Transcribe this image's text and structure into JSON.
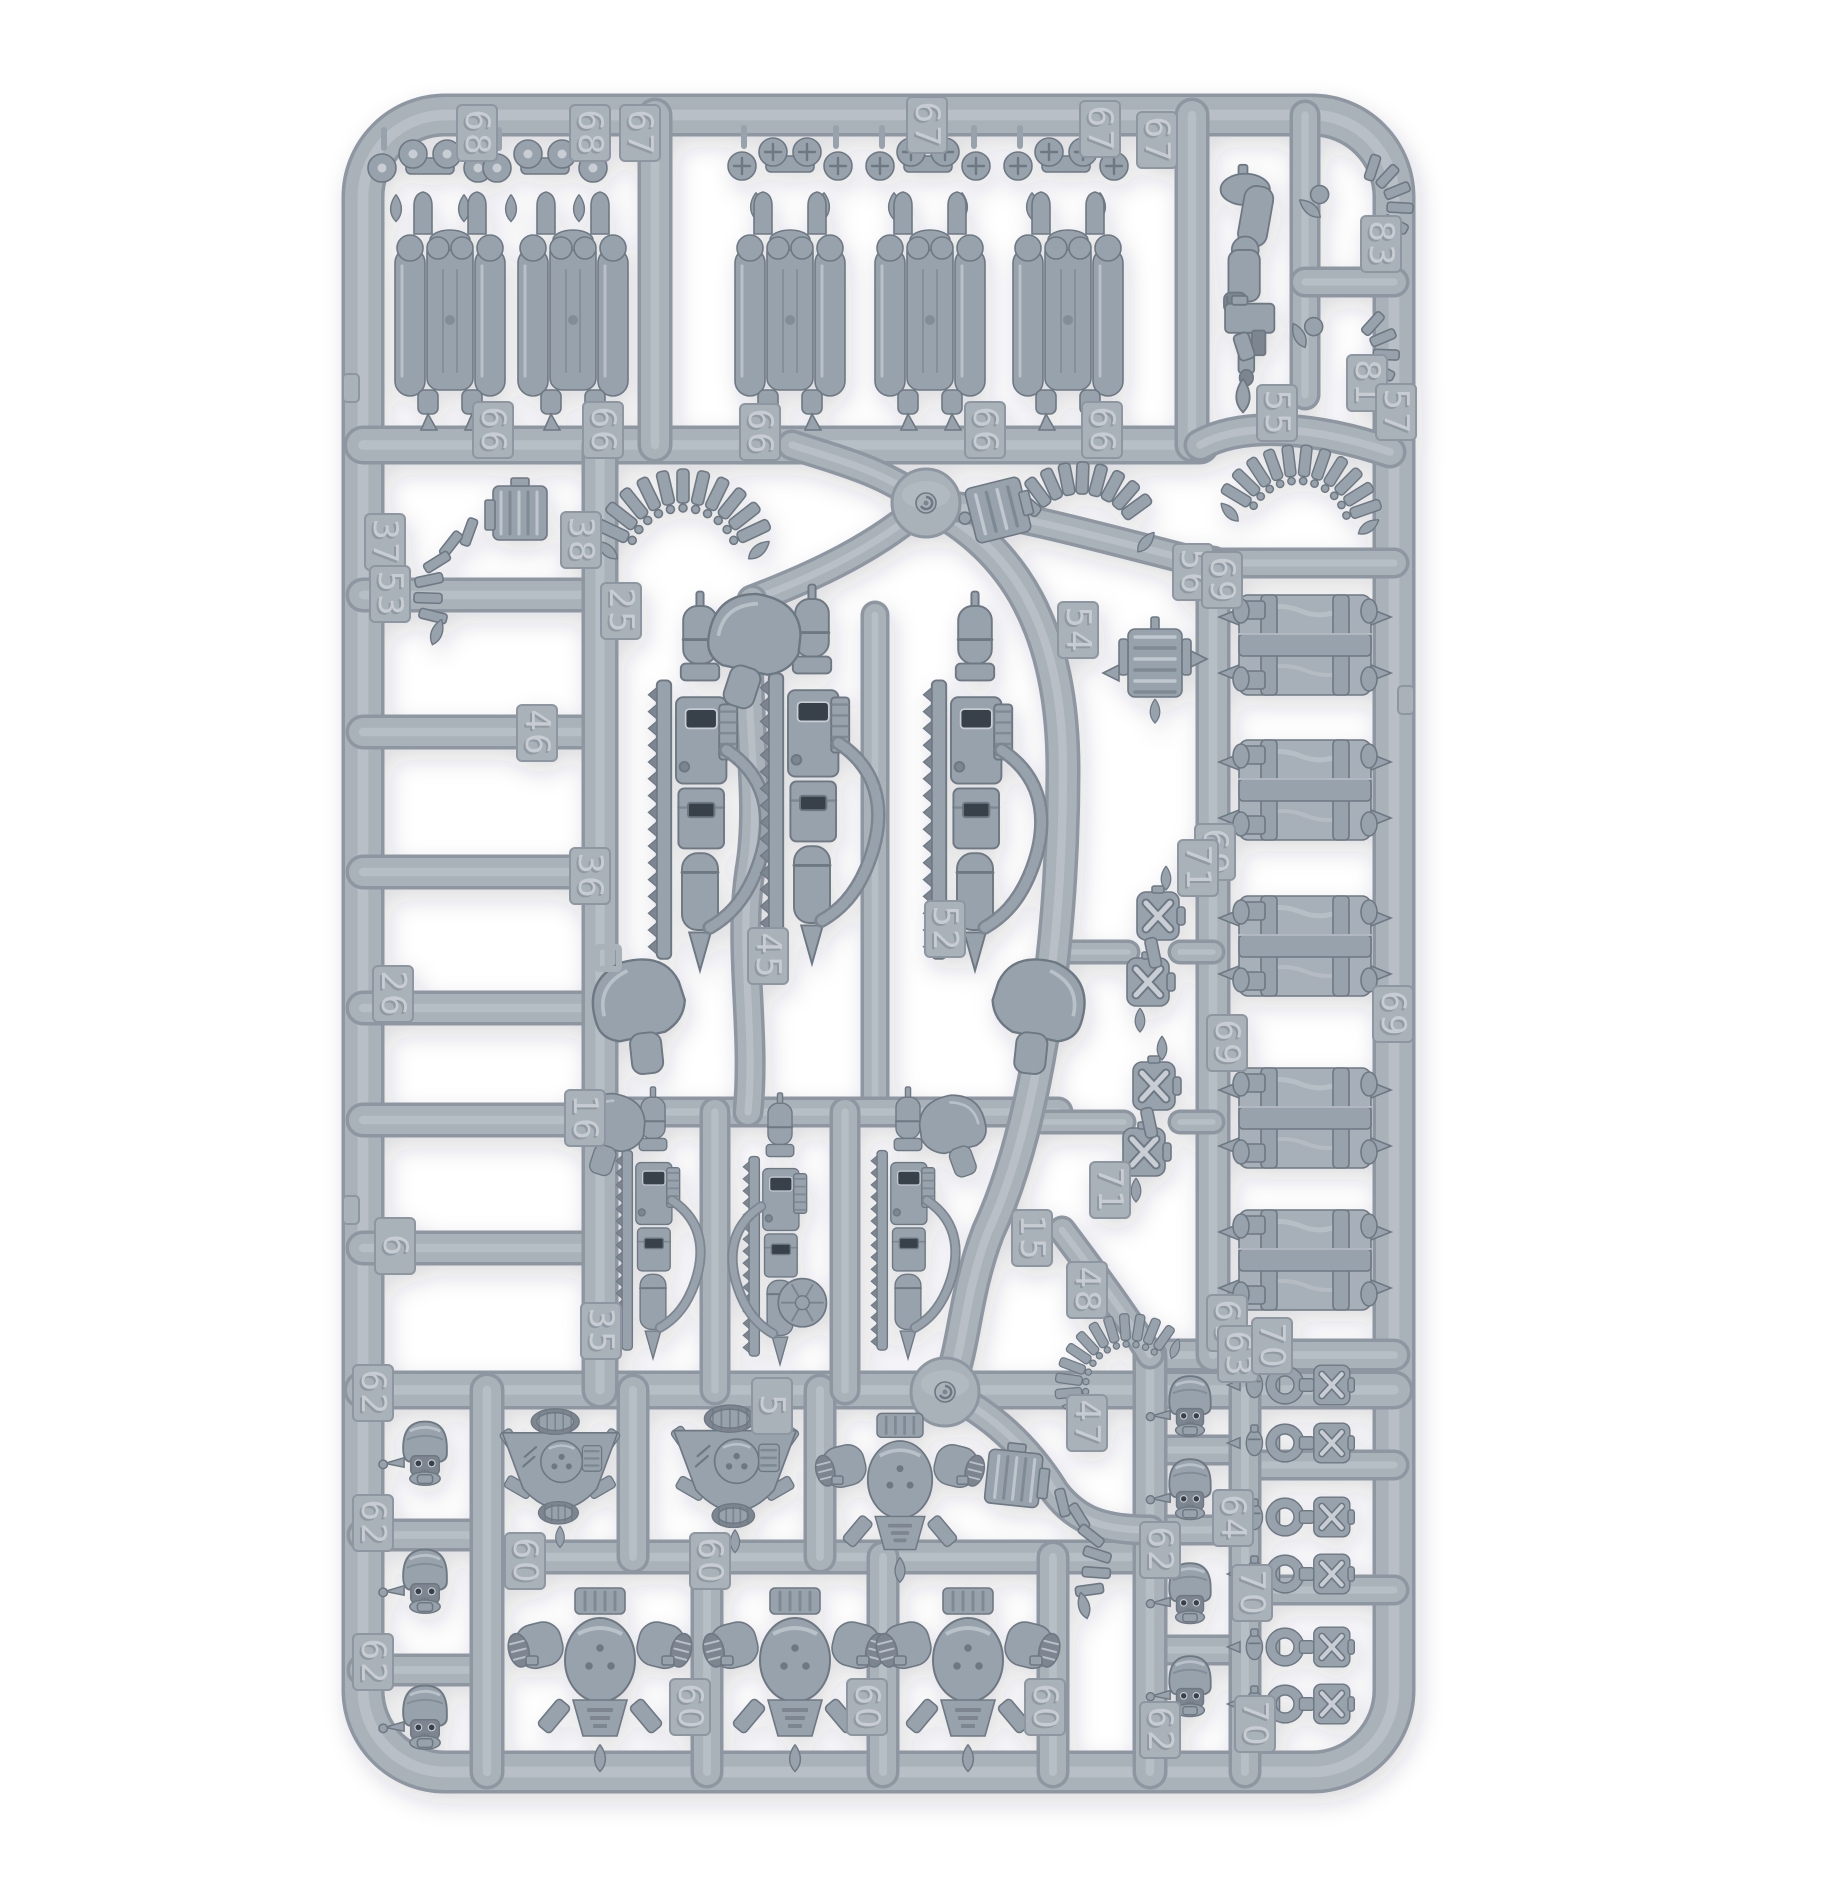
{
  "image": {
    "kind": "product-photo",
    "subject": "plastic-model-sprue",
    "background": "#ffffff",
    "palette": {
      "edge": "#8e97a1",
      "body": "#a9b1b9",
      "hi": "#c4cbd1",
      "pbase": "#98a2ac",
      "pdark": "#7b8590",
      "plight": "#c8ced4",
      "pline": "#6e7883",
      "win": "#384049",
      "crate": "#a7b0b8",
      "numfill": "#c9cfd5",
      "numshadow": "#7e8892"
    },
    "frame": {
      "x": 363,
      "y": 115,
      "w": 1031,
      "h": 1657,
      "rx": 82,
      "bar": 36
    },
    "hubs": [
      [
        926,
        503,
        34
      ],
      [
        945,
        1392,
        34
      ]
    ],
    "rails": [
      [
        363,
        445,
        1200,
        445,
        32
      ],
      [
        363,
        595,
        600,
        595,
        28
      ],
      [
        363,
        732,
        600,
        732,
        28
      ],
      [
        363,
        872,
        600,
        872,
        28
      ],
      [
        363,
        1008,
        600,
        1008,
        28
      ],
      [
        363,
        1120,
        600,
        1120,
        28
      ],
      [
        363,
        1248,
        600,
        1248,
        28
      ],
      [
        363,
        1390,
        1394,
        1390,
        32
      ],
      [
        363,
        1535,
        487,
        1535,
        26
      ],
      [
        363,
        1670,
        487,
        1670,
        26
      ],
      [
        487,
        1557,
        1150,
        1557,
        28
      ],
      [
        1150,
        1355,
        1394,
        1355,
        26
      ],
      [
        1150,
        1450,
        1245,
        1450,
        24
      ],
      [
        1150,
        1530,
        1245,
        1530,
        24
      ],
      [
        1150,
        1650,
        1245,
        1650,
        24
      ],
      [
        1245,
        1465,
        1394,
        1465,
        24
      ],
      [
        1245,
        1590,
        1394,
        1590,
        24
      ],
      [
        600,
        445,
        600,
        1390,
        30
      ],
      [
        487,
        1390,
        487,
        1772,
        28
      ],
      [
        633,
        1390,
        633,
        1557,
        26
      ],
      [
        820,
        1390,
        820,
        1557,
        26
      ],
      [
        1150,
        1355,
        1150,
        1772,
        28
      ],
      [
        1245,
        1390,
        1245,
        1772,
        26
      ],
      [
        707,
        1557,
        707,
        1772,
        26
      ],
      [
        883,
        1557,
        883,
        1772,
        26
      ],
      [
        1053,
        1557,
        1053,
        1772,
        26
      ],
      [
        1192,
        115,
        1192,
        445,
        28
      ],
      [
        655,
        115,
        655,
        445,
        28
      ],
      [
        1305,
        115,
        1305,
        395,
        24
      ],
      [
        1305,
        282,
        1394,
        282,
        24
      ],
      [
        1213,
        563,
        1213,
        1355,
        28
      ],
      [
        1213,
        563,
        1394,
        563,
        24
      ],
      [
        875,
        615,
        875,
        1112,
        22
      ],
      [
        600,
        1112,
        1058,
        1112,
        24
      ],
      [
        715,
        1112,
        715,
        1390,
        24
      ],
      [
        845,
        1112,
        845,
        1390,
        24
      ],
      [
        1065,
        952,
        1128,
        952,
        18
      ],
      [
        1180,
        952,
        1213,
        952,
        18
      ],
      [
        1042,
        1122,
        1124,
        1122,
        18
      ],
      [
        1180,
        1122,
        1213,
        1122,
        18
      ]
    ],
    "curves": [
      [
        "M926,503 C1015,548 1063,630 1063,770 C1063,930 1040,1120 988,1232 C962,1300 965,1355 945,1392",
        28
      ],
      [
        "M926,503 C882,470 838,460 792,445",
        24
      ],
      [
        "M926,503 C1005,510 1110,540 1213,566",
        24
      ],
      [
        "M926,503 C880,545 818,575 752,600",
        24
      ],
      [
        "M752,600 C740,700 764,790 750,870 C738,950 756,1030 748,1112",
        24
      ],
      [
        "M945,1392 C990,1412 1028,1448 1055,1492 C1078,1522 1105,1530 1150,1530",
        24
      ],
      [
        "M1062,1230 C1098,1278 1128,1318 1150,1355",
        22
      ],
      [
        "M1200,445 C1245,420 1320,428 1390,452",
        26
      ]
    ],
    "outer_nubs": [
      [
        351,
        388
      ],
      [
        351,
        1210
      ],
      [
        1406,
        700
      ]
    ],
    "labels": [
      [
        "68",
        477,
        133
      ],
      [
        "68",
        590,
        133
      ],
      [
        "67",
        640,
        133
      ],
      [
        "67",
        927,
        125
      ],
      [
        "67",
        1100,
        129
      ],
      [
        "67",
        1157,
        140
      ],
      [
        "66",
        493,
        430
      ],
      [
        "66",
        603,
        430
      ],
      [
        "66",
        760,
        432
      ],
      [
        "66",
        985,
        430
      ],
      [
        "66",
        1102,
        430
      ],
      [
        "55",
        1277,
        413
      ],
      [
        "83",
        1381,
        244
      ],
      [
        "81",
        1367,
        383
      ],
      [
        "57",
        1396,
        412
      ],
      [
        "37",
        385,
        542
      ],
      [
        "53",
        390,
        594
      ],
      [
        "46",
        537,
        733
      ],
      [
        "36",
        590,
        876
      ],
      [
        "26",
        393,
        994
      ],
      [
        "16",
        585,
        1118
      ],
      [
        "6",
        395,
        1246
      ],
      [
        "25",
        621,
        611
      ],
      [
        "38",
        581,
        540
      ],
      [
        "56",
        1193,
        572
      ],
      [
        "54",
        1078,
        630
      ],
      [
        "69",
        1222,
        580
      ],
      [
        "69",
        1215,
        852
      ],
      [
        "69",
        1227,
        1043
      ],
      [
        "69",
        1393,
        1014
      ],
      [
        "69",
        1227,
        1323
      ],
      [
        "45",
        768,
        956
      ],
      [
        "52",
        945,
        929
      ],
      [
        "71",
        1198,
        868
      ],
      [
        "71",
        1110,
        1190
      ],
      [
        "35",
        601,
        1331
      ],
      [
        "5",
        772,
        1406
      ],
      [
        "15",
        1032,
        1238
      ],
      [
        "48",
        1087,
        1290
      ],
      [
        "62",
        373,
        1393
      ],
      [
        "62",
        373,
        1523
      ],
      [
        "62",
        373,
        1662
      ],
      [
        "62",
        1160,
        1550
      ],
      [
        "62",
        1160,
        1730
      ],
      [
        "60",
        525,
        1561
      ],
      [
        "60",
        710,
        1561
      ],
      [
        "60",
        690,
        1707
      ],
      [
        "60",
        867,
        1707
      ],
      [
        "60",
        1045,
        1707
      ],
      [
        "47",
        1087,
        1423
      ],
      [
        "63",
        1238,
        1354
      ],
      [
        "70",
        1272,
        1346
      ],
      [
        "64",
        1233,
        1518
      ],
      [
        "70",
        1252,
        1593
      ],
      [
        "70",
        1255,
        1724
      ]
    ],
    "parts": [
      {
        "t": "vent",
        "x": 430,
        "y": 172
      },
      {
        "t": "vent",
        "x": 545,
        "y": 172
      },
      {
        "t": "vent",
        "x": 790,
        "y": 170,
        "v": 2
      },
      {
        "t": "vent",
        "x": 928,
        "y": 170,
        "v": 2
      },
      {
        "t": "vent",
        "x": 1066,
        "y": 170,
        "v": 2
      },
      {
        "t": "bpack",
        "x": 450,
        "y": 310
      },
      {
        "t": "bpack",
        "x": 573,
        "y": 310
      },
      {
        "t": "bpack",
        "x": 790,
        "y": 310
      },
      {
        "t": "bpack",
        "x": 930,
        "y": 310
      },
      {
        "t": "bpack",
        "x": 1068,
        "y": 310
      },
      {
        "t": "armp",
        "x": 1243,
        "y": 288,
        "s": 1.12
      },
      {
        "t": "strap",
        "x": 1356,
        "y": 182,
        "r": -10
      },
      {
        "t": "strap",
        "x": 1352,
        "y": 330,
        "r": 14
      },
      {
        "t": "beltfeed",
        "x": 485,
        "y": 518
      },
      {
        "t": "beltbig",
        "x": 683,
        "y": 520
      },
      {
        "t": "beltbox",
        "x": 1060,
        "y": 508
      },
      {
        "t": "beltbig",
        "x": 1302,
        "y": 492,
        "r": 6,
        "s": 0.92
      },
      {
        "t": "hub",
        "x": 926,
        "y": 503
      },
      {
        "t": "hub",
        "x": 945,
        "y": 1392
      },
      {
        "t": "gun",
        "x": 700,
        "y": 822,
        "s": 1.2,
        "pad": "bl"
      },
      {
        "t": "gun",
        "x": 812,
        "y": 815,
        "s": 1.2,
        "pad": "tl"
      },
      {
        "t": "gun",
        "x": 975,
        "y": 822,
        "s": 1.2,
        "pad": "br"
      },
      {
        "t": "feeder",
        "x": 1155,
        "y": 665
      },
      {
        "t": "crate",
        "x": 1305,
        "y": 645
      },
      {
        "t": "crate",
        "x": 1305,
        "y": 790
      },
      {
        "t": "crate",
        "x": 1305,
        "y": 946
      },
      {
        "t": "crate",
        "x": 1305,
        "y": 1118
      },
      {
        "t": "crate",
        "x": 1305,
        "y": 1260
      },
      {
        "t": "xpair",
        "x": 1152,
        "y": 952
      },
      {
        "t": "xpair",
        "x": 1148,
        "y": 1122
      },
      {
        "t": "gun",
        "x": 653,
        "y": 1252,
        "s": 0.86,
        "pad": "tl"
      },
      {
        "t": "gun",
        "x": 780,
        "y": 1258,
        "s": 0.86,
        "drum": true
      },
      {
        "t": "gun",
        "x": 908,
        "y": 1252,
        "s": 0.86,
        "pad": "tr"
      },
      {
        "t": "beltbig",
        "x": 1112,
        "y": 1358,
        "r": -30,
        "s": 0.78
      },
      {
        "t": "head",
        "x": 425,
        "y": 1452,
        "s": 0.95
      },
      {
        "t": "head",
        "x": 425,
        "y": 1580,
        "s": 0.95
      },
      {
        "t": "head",
        "x": 425,
        "y": 1716,
        "s": 0.95
      },
      {
        "t": "jetpack",
        "x": 560,
        "y": 1468,
        "s": 0.8
      },
      {
        "t": "jetpack",
        "x": 735,
        "y": 1468,
        "s": 0.85
      },
      {
        "t": "bigpack",
        "x": 900,
        "y": 1487,
        "s": 0.92
      },
      {
        "t": "beltfeed",
        "x": 1048,
        "y": 1487,
        "flip": true,
        "r": 6
      },
      {
        "t": "bigpack",
        "x": 600,
        "y": 1668
      },
      {
        "t": "bigpack",
        "x": 795,
        "y": 1668
      },
      {
        "t": "bigpack",
        "x": 968,
        "y": 1668
      },
      {
        "t": "head",
        "x": 1190,
        "y": 1405,
        "s": 0.9
      },
      {
        "t": "head",
        "x": 1190,
        "y": 1488,
        "s": 0.9
      },
      {
        "t": "head",
        "x": 1190,
        "y": 1592,
        "s": 0.9
      },
      {
        "t": "head",
        "x": 1190,
        "y": 1685,
        "s": 0.9
      },
      {
        "t": "pouch",
        "x": 1312,
        "y": 1385,
        "s": 0.9
      },
      {
        "t": "pouch",
        "x": 1312,
        "y": 1443,
        "s": 0.9
      },
      {
        "t": "pouch",
        "x": 1312,
        "y": 1517,
        "s": 0.9
      },
      {
        "t": "pouch",
        "x": 1312,
        "y": 1574,
        "s": 0.9
      },
      {
        "t": "pouch",
        "x": 1312,
        "y": 1647,
        "s": 0.9
      },
      {
        "t": "pouch",
        "x": 1312,
        "y": 1704,
        "s": 0.9
      },
      {
        "t": "sq",
        "x": 608,
        "y": 958
      }
    ]
  }
}
